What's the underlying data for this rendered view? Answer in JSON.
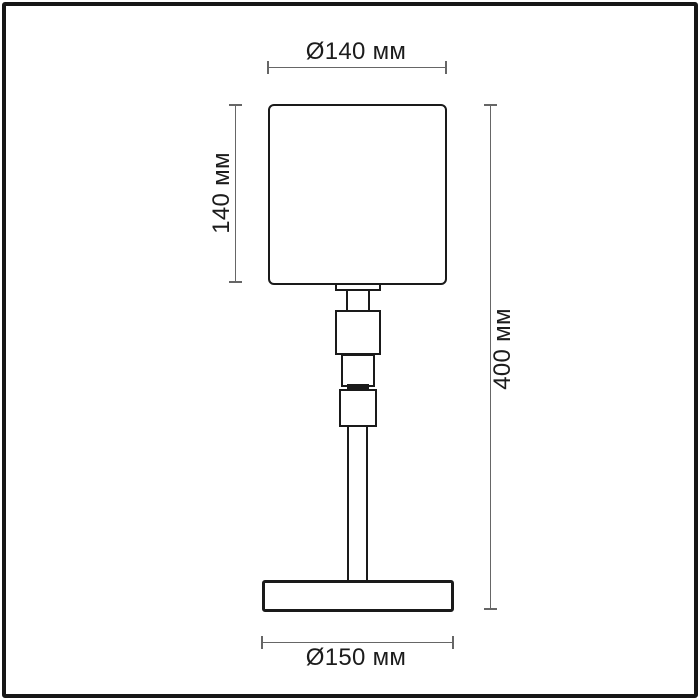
{
  "figure": {
    "type": "technical-dimension-drawing",
    "subject": "table lamp",
    "units": "мм"
  },
  "dims": {
    "shade_diameter": {
      "label": "Ø140 мм",
      "value": 140,
      "unit": "мм"
    },
    "shade_height": {
      "label": "140 мм",
      "value": 140,
      "unit": "мм"
    },
    "total_height": {
      "label": "400 мм",
      "value": 400,
      "unit": "мм"
    },
    "base_diameter": {
      "label": "Ø150 мм",
      "value": 150,
      "unit": "мм"
    }
  },
  "colors": {
    "outline": "#1a1a1a",
    "dimension_line": "#666666",
    "label_text": "#1c1c1c",
    "background": "#ffffff",
    "frame_border": "#161616"
  },
  "parts": [
    "lampshade",
    "shade-fitter",
    "socket-neck",
    "upper-decor-block",
    "middle-decor-block",
    "connector-ring",
    "lower-decor-block",
    "stem",
    "base"
  ]
}
